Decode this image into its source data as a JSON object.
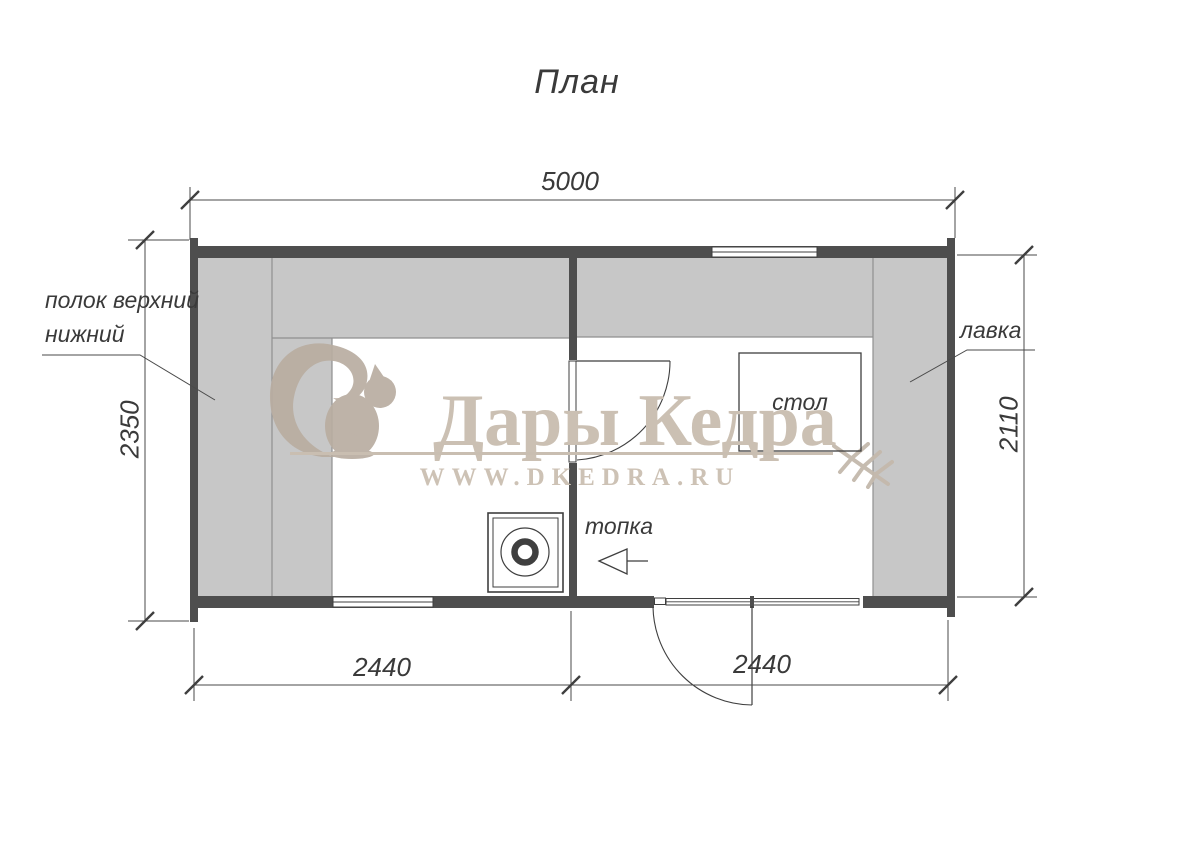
{
  "title": "План",
  "watermark": {
    "brand": "Дары Кедра",
    "url": "WWW.DKEDRA.RU"
  },
  "labels": {
    "shelf_upper": "полок верхний",
    "shelf_lower": "нижний",
    "bench": "лавка",
    "table": "стол",
    "firebox": "топка"
  },
  "dimensions": {
    "total_width": "5000",
    "left_depth": "2350",
    "right_depth": "2110",
    "bottom_left": "2440",
    "bottom_right": "2440"
  },
  "colors": {
    "wall": "#4e4e4e",
    "bench_fill": "#c7c7c7",
    "bench_edge": "#8f8f8f",
    "line": "#3f3f3f",
    "watermark_beige": "#c9beb1"
  }
}
